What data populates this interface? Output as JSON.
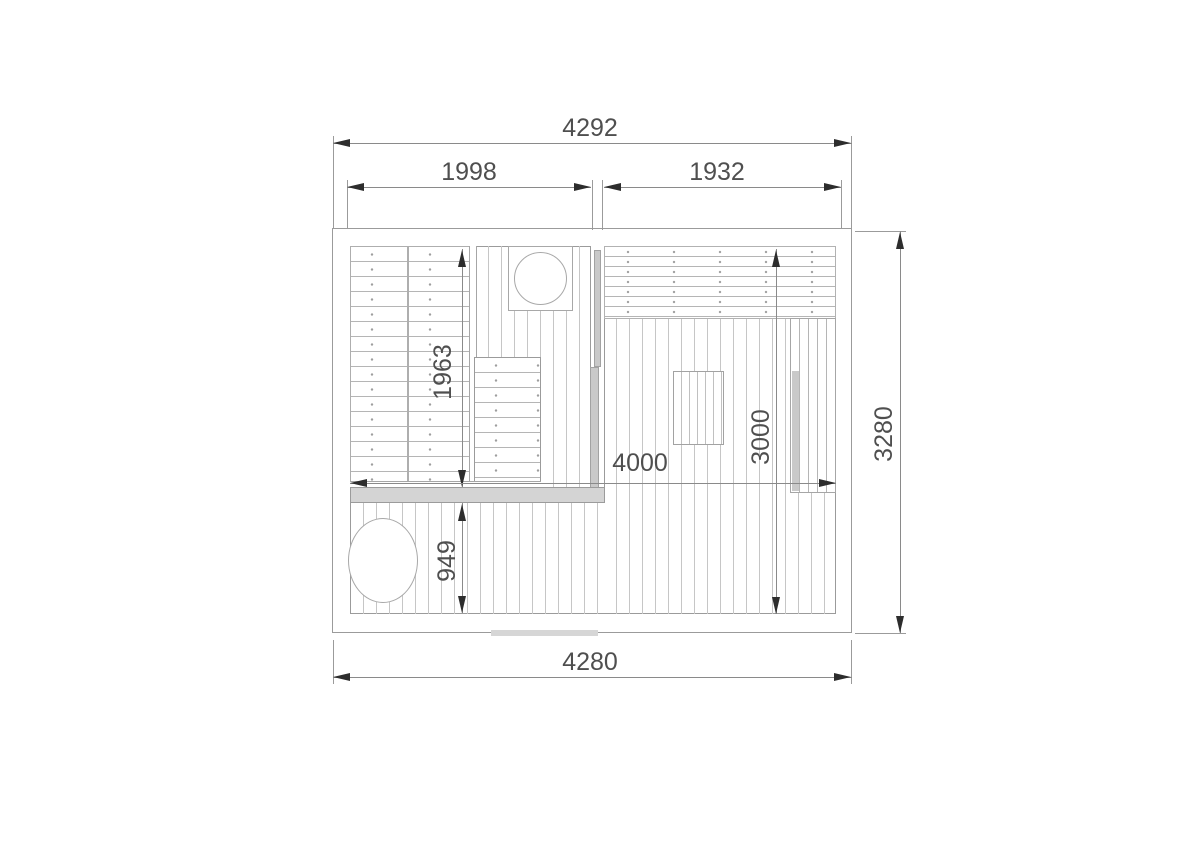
{
  "diagram": {
    "type": "floor-plan",
    "subject": "sauna-and-relax-room-layout",
    "unit": "mm",
    "labels": {
      "top_overall": "4292",
      "top_left_room": "1998",
      "top_right_room": "1932",
      "right_overall": "3280",
      "bottom_overall": "4280",
      "sauna_bench_length": "1963",
      "terrace_depth": "949",
      "interior_width": "4000",
      "right_room_depth": "3000"
    },
    "colors": {
      "background": "#ffffff",
      "outline": "#9b9b9b",
      "slat_line": "#b5b5b5",
      "floor_line": "#c6c6c6",
      "dimension_line": "#8a8a8a",
      "arrow": "#2d2d2d",
      "text": "#4f4f4f",
      "glass_fill": "#c9c9c9"
    }
  }
}
